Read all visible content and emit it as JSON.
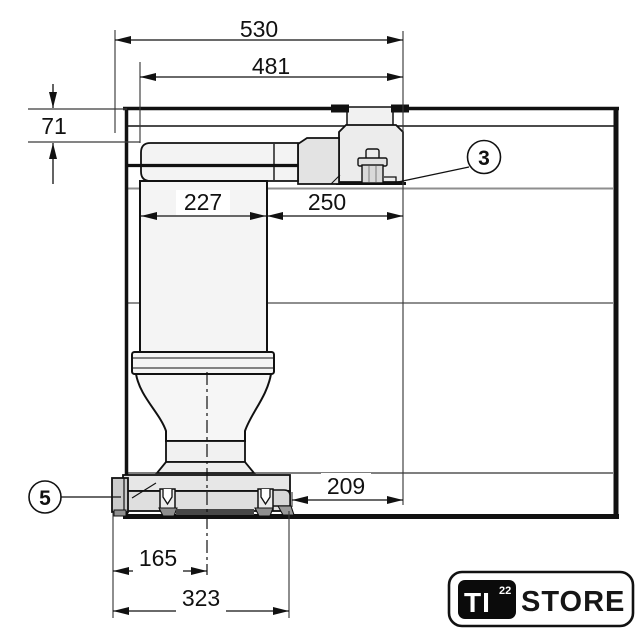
{
  "drawing": {
    "dimensions": {
      "overall_width": "530",
      "unit_width": "481",
      "worktop_offset": "71",
      "column_width": "227",
      "side_clearance": "250",
      "base_clearance": "209",
      "outlet_center": "165",
      "base_width": "323"
    },
    "callouts": {
      "part_3": "3",
      "part_5": "5"
    }
  },
  "logo": {
    "brand": "TI",
    "superscript": "22",
    "name": "STORE"
  },
  "colors": {
    "outline": "#1a1a1a",
    "shelf_line": "#8e8e8e",
    "unit_fill": "#f3f3f3",
    "logo_black": "#0b0b0b"
  }
}
